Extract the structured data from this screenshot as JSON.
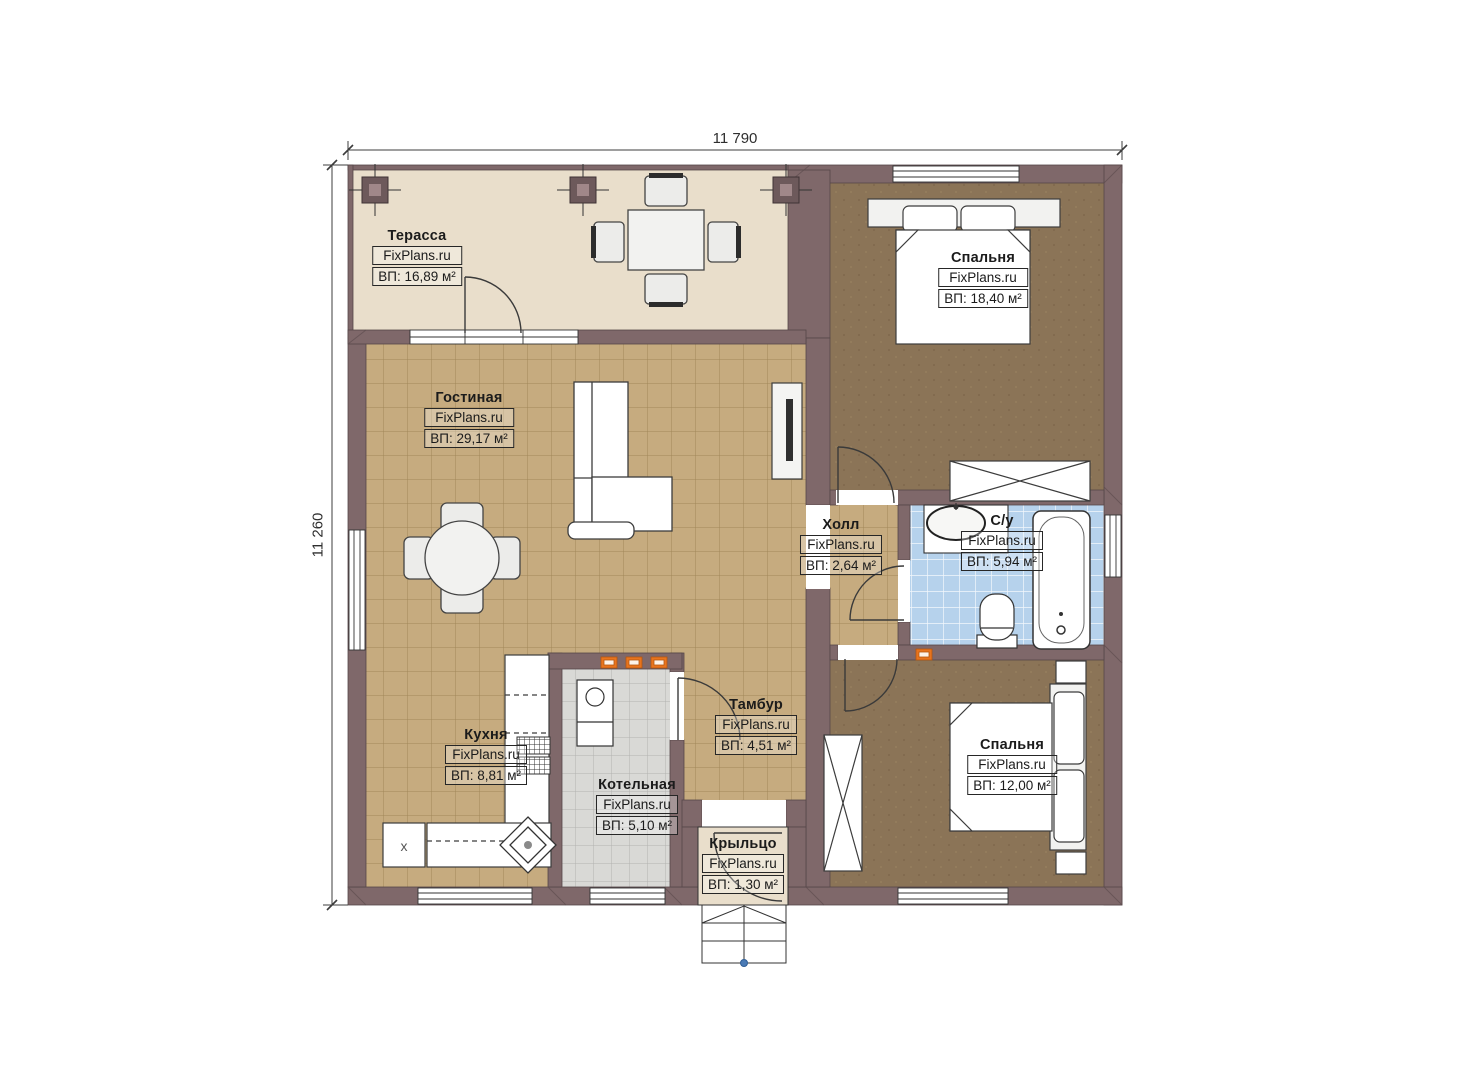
{
  "dimensions": {
    "width_label": "11 790",
    "height_label": "11 260"
  },
  "fixtures": {
    "fridge_mark": "x"
  },
  "rooms": [
    {
      "id": "terrace",
      "name": "Терасса",
      "brand": "FixPlans.ru",
      "area": "ВП: 16,89 м²"
    },
    {
      "id": "living",
      "name": "Гостиная",
      "brand": "FixPlans.ru",
      "area": "ВП: 29,17 м²"
    },
    {
      "id": "bedroom1",
      "name": "Спальня",
      "brand": "FixPlans.ru",
      "area": "ВП: 18,40 м²"
    },
    {
      "id": "hall",
      "name": "Холл",
      "brand": "FixPlans.ru",
      "area": "ВП: 2,64 м²"
    },
    {
      "id": "bathroom",
      "name": "С/у",
      "brand": "FixPlans.ru",
      "area": "ВП: 5,94 м²"
    },
    {
      "id": "kitchen",
      "name": "Кухня",
      "brand": "FixPlans.ru",
      "area": "ВП: 8,81 м²"
    },
    {
      "id": "boiler",
      "name": "Котельная",
      "brand": "FixPlans.ru",
      "area": "ВП: 5,10 м²"
    },
    {
      "id": "vestibule",
      "name": "Тамбур",
      "brand": "FixPlans.ru",
      "area": "ВП: 4,51 м²"
    },
    {
      "id": "bedroom2",
      "name": "Спальня",
      "brand": "FixPlans.ru",
      "area": "ВП: 12,00 м²"
    },
    {
      "id": "porch",
      "name": "Крыльцо",
      "brand": "FixPlans.ru",
      "area": "ВП: 1,30 м²"
    }
  ],
  "colors": {
    "wall": "#7f686a",
    "floor_tile": "#c6ab7f",
    "bedroom_floor": "#8b7457",
    "bathroom_tile": "#b6d2ec",
    "terrace_floor": "#e9decb",
    "boiler_floor": "#d9d9d6",
    "vent": "#e8741e",
    "accent_dot": "#4a7ab5"
  }
}
